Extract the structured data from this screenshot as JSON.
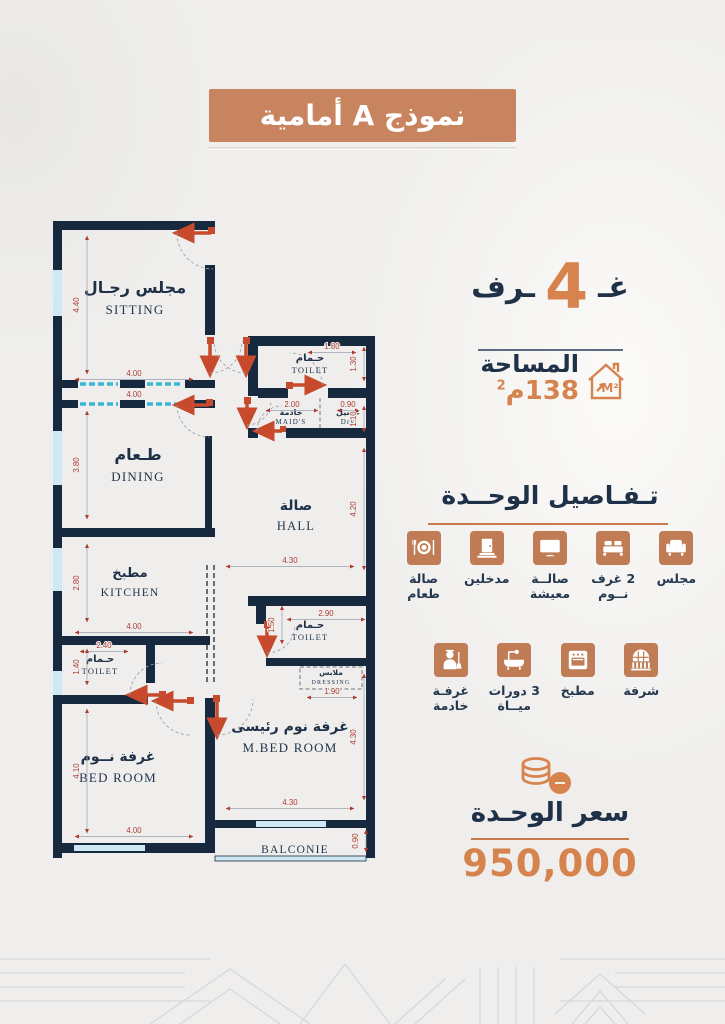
{
  "banner": {
    "title": "نموذج A أمامية"
  },
  "summary": {
    "rooms_prefix": "غـ",
    "rooms_count": "4",
    "rooms_suffix": "ـرف",
    "area_label": "المساحة",
    "area_value": "138م",
    "area_sup": "2",
    "house_icon_text": "M²"
  },
  "details": {
    "title": "تـفـاصيل الوحــدة",
    "row1": [
      {
        "icon": "sofa",
        "label_lines": [
          "مجلس"
        ]
      },
      {
        "icon": "bed",
        "label_lines": [
          "2 غرف",
          "نــوم"
        ]
      },
      {
        "icon": "tv",
        "label_lines": [
          "صالــة",
          "معيشة"
        ]
      },
      {
        "icon": "door",
        "label_lines": [
          "مدخلين"
        ]
      },
      {
        "icon": "dining",
        "label_lines": [
          "صالة",
          "طعام"
        ]
      }
    ],
    "row2": [
      {
        "icon": "balcony",
        "label_lines": [
          "شرفة"
        ]
      },
      {
        "icon": "oven",
        "label_lines": [
          "مطبخ"
        ]
      },
      {
        "icon": "bath",
        "label_lines": [
          "3 دورات",
          "ميــاة"
        ]
      },
      {
        "icon": "maid",
        "label_lines": [
          "غرفـة",
          "خادمة"
        ]
      }
    ]
  },
  "price": {
    "label": "سعر الوحـدة",
    "value": "950,000"
  },
  "floorplan": {
    "rooms": [
      {
        "ar": "مجلس رجـال",
        "en": "SITTING",
        "x": 97,
        "y": 100,
        "as": 16,
        "es": 13,
        "ey": 121
      },
      {
        "ar": "طـعام",
        "en": "DINING",
        "x": 100,
        "y": 267,
        "as": 16,
        "es": 13,
        "ey": 288
      },
      {
        "ar": "مطبخ",
        "en": "KITCHEN",
        "x": 92,
        "y": 384,
        "as": 13,
        "es": 11.5,
        "ey": 403
      },
      {
        "ar": "صالة",
        "en": "HALL",
        "x": 258,
        "y": 317,
        "as": 14,
        "es": 12.5,
        "ey": 337
      },
      {
        "ar": "حـمام",
        "en": "TOILET",
        "x": 272,
        "y": 168,
        "as": 10,
        "es": 8.5,
        "ey": 180
      },
      {
        "ar": "خادمة",
        "en": "MAID'S",
        "x": 253,
        "y": 222,
        "as": 8,
        "es": 7,
        "ey": 231
      },
      {
        "ar": "غسيل",
        "en": "Dry",
        "x": 310,
        "y": 222,
        "as": 8,
        "es": 7,
        "ey": 231
      },
      {
        "ar": "حـمام",
        "en": "TOILET",
        "x": 62,
        "y": 469,
        "as": 10,
        "es": 8.5,
        "ey": 481
      },
      {
        "ar": "حـمام",
        "en": "TOILET",
        "x": 272,
        "y": 435,
        "as": 10,
        "es": 8.5,
        "ey": 447
      },
      {
        "ar": "ملابس",
        "en": "DRESSING",
        "x": 293,
        "y": 482,
        "as": 7.5,
        "es": 6,
        "ey": 491
      },
      {
        "ar": "غرفة نوم رئيسى",
        "en": "M.BED  ROOM",
        "x": 252,
        "y": 538,
        "as": 14,
        "es": 13,
        "ey": 559
      },
      {
        "ar": "غرفة نــوم",
        "en": "BED  ROOM",
        "x": 80,
        "y": 568,
        "as": 14,
        "es": 13,
        "ey": 589
      },
      {
        "ar": "",
        "en": "BALCONIE",
        "x": 257,
        "y": 660,
        "as": 0,
        "es": 11.5,
        "ey": 660
      }
    ],
    "dims": [
      {
        "t": "4.00",
        "x": 96,
        "y": 183,
        "v": 0,
        "len": 118
      },
      {
        "t": "4.00",
        "x": 96,
        "y": 204,
        "v": 0,
        "len": 0
      },
      {
        "t": "4.40",
        "x": 41,
        "y": 112,
        "v": 1,
        "len": 138
      },
      {
        "t": "3.80",
        "x": 41,
        "y": 272,
        "v": 1,
        "len": 108
      },
      {
        "t": "2.80",
        "x": 41,
        "y": 390,
        "v": 1,
        "len": 78
      },
      {
        "t": "4.00",
        "x": 96,
        "y": 436,
        "v": 0,
        "len": 118
      },
      {
        "t": "2.40",
        "x": 66,
        "y": 455,
        "v": 0,
        "len": 48
      },
      {
        "t": "1.40",
        "x": 41,
        "y": 474,
        "v": 1,
        "len": 36
      },
      {
        "t": "4.10",
        "x": 41,
        "y": 578,
        "v": 1,
        "len": 124
      },
      {
        "t": "4.00",
        "x": 96,
        "y": 640,
        "v": 0,
        "len": 118
      },
      {
        "t": "1.80",
        "x": 294,
        "y": 156,
        "v": 0,
        "len": 48
      },
      {
        "t": "1.30",
        "x": 318,
        "y": 171,
        "v": 1,
        "len": 34
      },
      {
        "t": "2.00",
        "x": 254,
        "y": 214,
        "v": 0,
        "len": 52
      },
      {
        "t": "0.90",
        "x": 310,
        "y": 214,
        "v": 0,
        "len": 22
      },
      {
        "t": "1.10",
        "x": 318,
        "y": 226,
        "v": 1,
        "len": 26
      },
      {
        "t": "4.20",
        "x": 318,
        "y": 316,
        "v": 1,
        "len": 122
      },
      {
        "t": "4.30",
        "x": 252,
        "y": 370,
        "v": 0,
        "len": 128
      },
      {
        "t": "2.90",
        "x": 288,
        "y": 423,
        "v": 0,
        "len": 78
      },
      {
        "t": "1.50",
        "x": 236,
        "y": 432,
        "v": 1,
        "len": 38
      },
      {
        "t": "1.90",
        "x": 294,
        "y": 501,
        "v": 0,
        "len": 50
      },
      {
        "t": "4.30",
        "x": 318,
        "y": 544,
        "v": 1,
        "len": 126
      },
      {
        "t": "4.30",
        "x": 252,
        "y": 612,
        "v": 0,
        "len": 128
      },
      {
        "t": "0.90",
        "x": 320,
        "y": 648,
        "v": 1,
        "len": 22
      }
    ]
  },
  "colors": {
    "accent_terracotta": "#c8845f",
    "icon_terracotta": "#bf7c55",
    "number_orange": "#d6834e",
    "navy_text": "#1e3148",
    "wall_navy": "#17293e",
    "window_blue": "#cfe9f4",
    "dimension_red": "#b03a2e",
    "background": "#efeeec"
  }
}
